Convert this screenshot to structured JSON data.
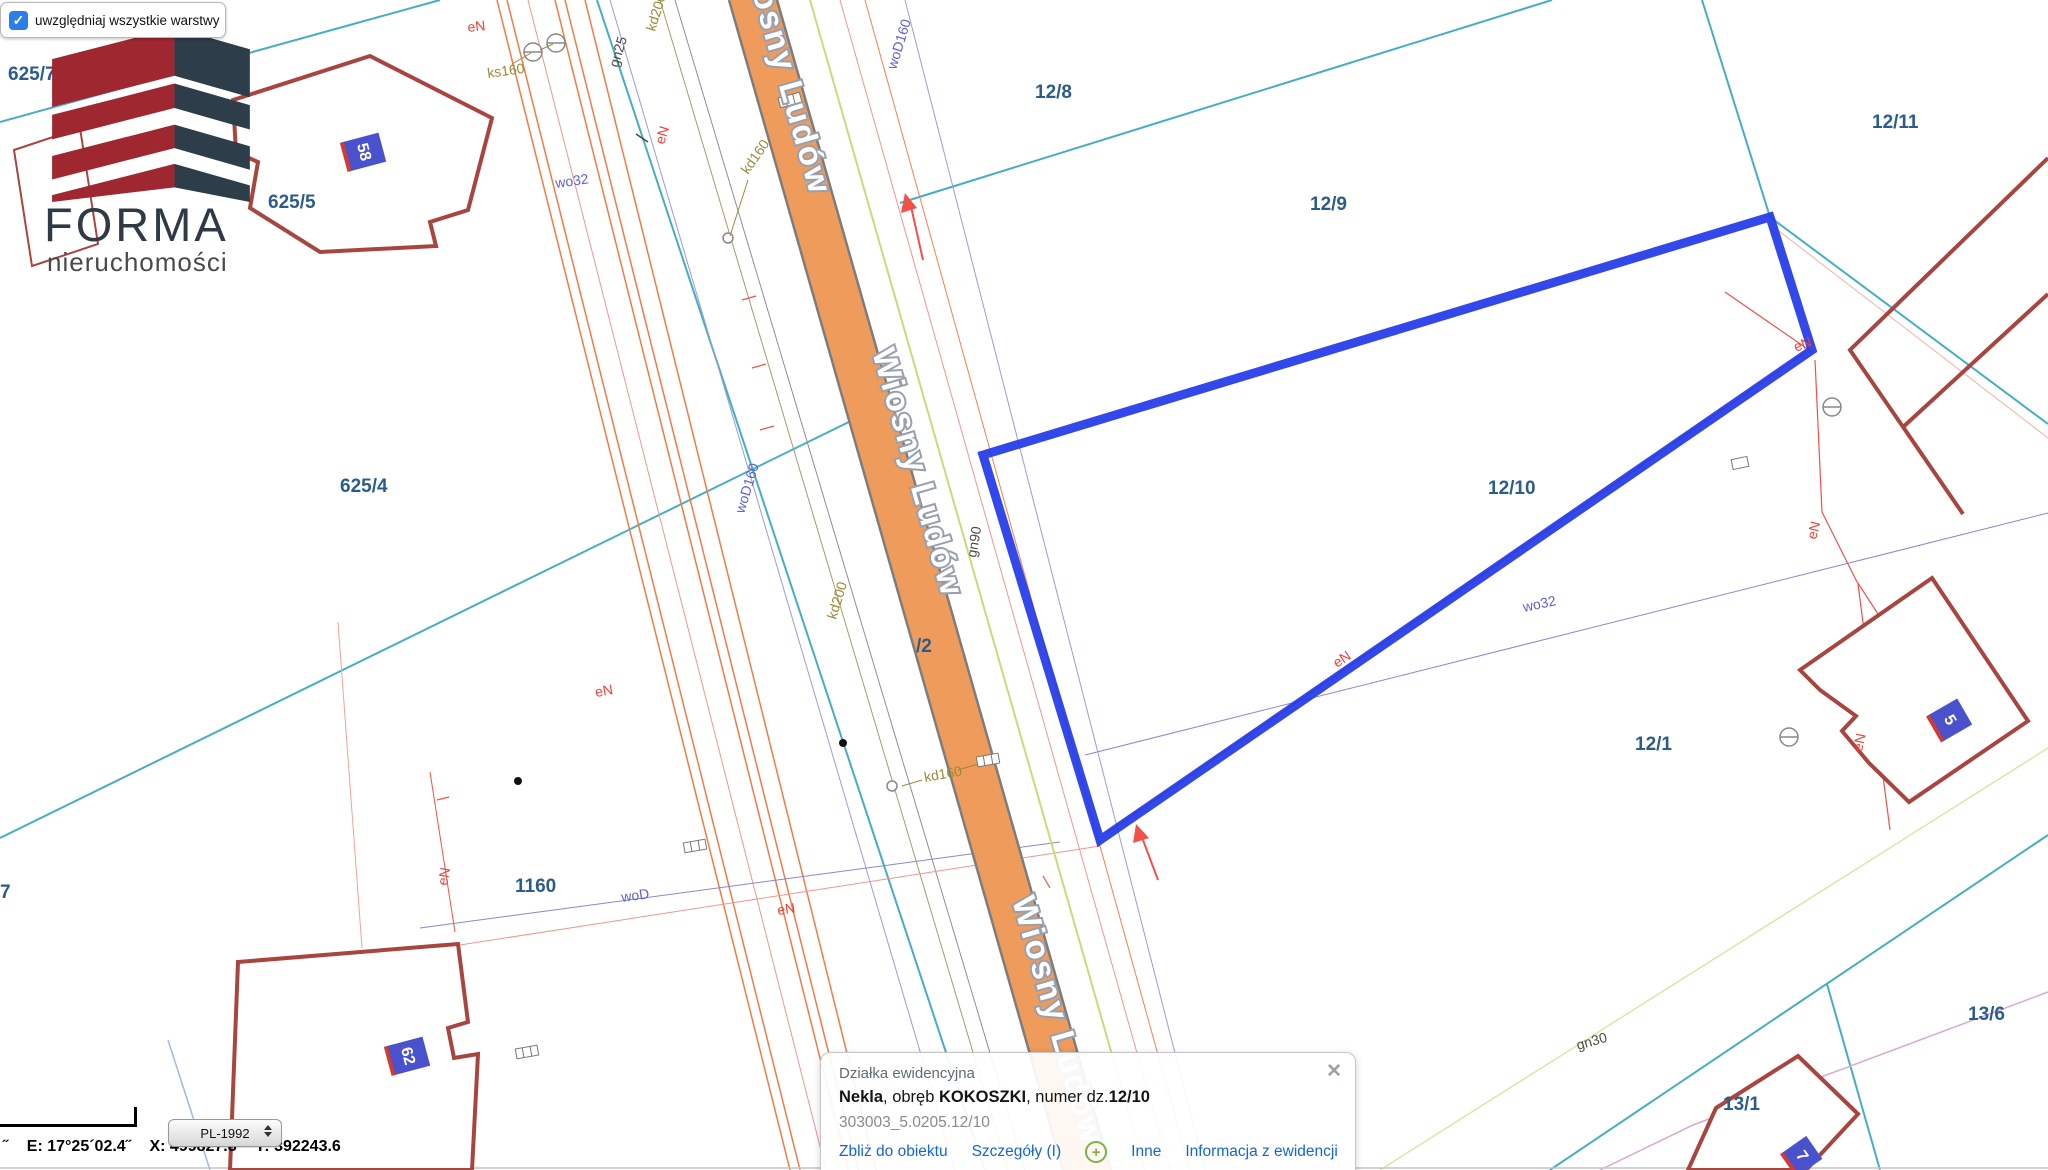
{
  "overlay": {
    "layers_label": "uwzględniaj wszystkie warstwy"
  },
  "logo": {
    "title": "FORMA",
    "subtitle": "nieruchomości"
  },
  "statusbar": {
    "tick": "˝",
    "e": "E: 17°25´02.4˝",
    "x": "X: 499827.8",
    "y": "Y: 392243.6",
    "crs": "PL-1992"
  },
  "popup": {
    "title": "Działka ewidencyjna",
    "name": "Nekla",
    "sep1": ", obręb ",
    "obreb": "KOKOSZKI",
    "sep2": ", numer dz.",
    "number": "12/10",
    "id": "303003_5.0205.12/10",
    "close": "✕",
    "links": {
      "zoom": "Zbliż do obiektu",
      "details": "Szczegóły (I)",
      "other": "Inne",
      "registry": "Informacja z ewidencji"
    }
  },
  "map": {
    "street": "Wiosny Ludów",
    "parcels": {
      "p625_7": "625/7",
      "p625_5": "625/5",
      "p625_4": "625/4",
      "p12_8": "12/8",
      "p12_9": "12/9",
      "p12_10": "12/10",
      "p12_11": "12/11",
      "p12_1": "12/1",
      "p1160": "1160",
      "p13_6": "13/6",
      "p13_1": "13/1",
      "p7": "7",
      "p_2": "/2"
    },
    "buildings": {
      "b58": "58",
      "b62": "62",
      "b5": "5",
      "b7": "7"
    },
    "utilities": {
      "eN": [
        "eN",
        "eN",
        "eN",
        "eN",
        "eN",
        "eN",
        "eN",
        "eN",
        "eN"
      ],
      "kd200": [
        "kd200",
        "kd200"
      ],
      "kd160": [
        "kd160",
        "kd160"
      ],
      "ks160": "ks160",
      "gn25": "gn25",
      "gn90": "gn90",
      "gn30": "gn30",
      "wo32": [
        "wo32",
        "wo32"
      ],
      "woD160": [
        "woD160",
        "woD160"
      ],
      "woD": "woD"
    }
  },
  "colors": {
    "highlight": "#2238e8",
    "road_fill": "#ef9b5c",
    "teal": "#45aec2",
    "parcel_label": "#2b5c8a",
    "utility_red": "#f04138",
    "utility_olive": "#9a8a3a",
    "utility_purple": "#5f5fd3",
    "building_outline": "#a8453f"
  }
}
